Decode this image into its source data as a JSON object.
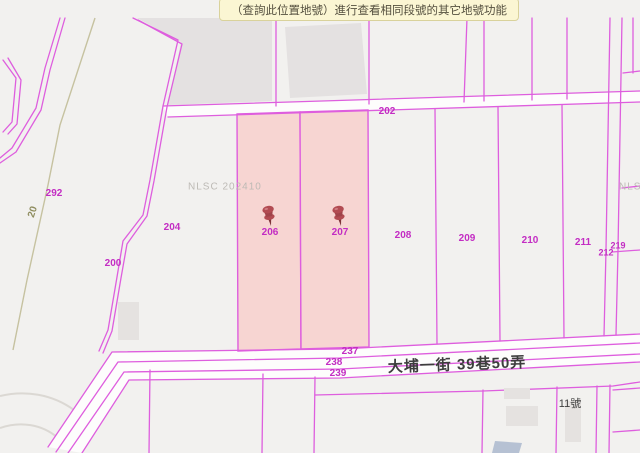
{
  "tooltip": {
    "text": "（查詢此位置地號）進行查看相同段號的其它地號功能"
  },
  "map": {
    "watermark_left": "NLSC 202410",
    "watermark_right": "NLSC",
    "street_name": "大埔一街 39巷50弄",
    "house_number": "11號",
    "contour_label": "20",
    "selected_parcel_ids": [
      "206",
      "207"
    ],
    "parcel_labels": [
      {
        "id": "292"
      },
      {
        "id": "204"
      },
      {
        "id": "200"
      },
      {
        "id": "206"
      },
      {
        "id": "207"
      },
      {
        "id": "208"
      },
      {
        "id": "209"
      },
      {
        "id": "210"
      },
      {
        "id": "211"
      },
      {
        "id": "219"
      },
      {
        "id": "212"
      },
      {
        "id": "202"
      },
      {
        "id": "237"
      },
      {
        "id": "238"
      },
      {
        "id": "239"
      }
    ],
    "colors": {
      "background": "#f2f1ef",
      "boundary": "#de5ede",
      "label": "#c32dc3",
      "selected_fill": "#f7d5d2",
      "zone_gray": "#e4e1e1",
      "contour": "#c6c2a0",
      "pin": "#b24b52"
    }
  }
}
